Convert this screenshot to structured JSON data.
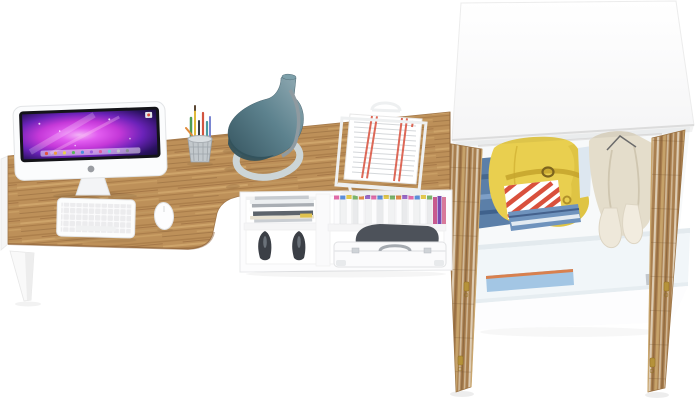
{
  "scene": {
    "description": "3D product render of a home office furniture set: wall desk with iMac, lamp and document tray over an open cubby shelf, next to a white wardrobe with open rustic-wood doors full of clothes",
    "background": "#ffffff",
    "objects": [
      "wooden desk with white frame and leg",
      "imac computer",
      "white keyboard",
      "white mouse",
      "pen cup with pens and pencils",
      "teal cone desk lamp",
      "wire document tray with papers",
      "open cubby shelf unit",
      "magazine stack",
      "black high-heel shoes",
      "row of white binders with colored tabs",
      "white suitcase",
      "wardrobe with open rustic doors",
      "yellow belted jacket",
      "beige coat",
      "folded jeans",
      "red striped folded shirt",
      "light blue storage box",
      "cream mittens"
    ]
  },
  "colors": {
    "wood": "#bd9059",
    "door_wood": "#a97f4f",
    "lamp_base": "#ccd5d7",
    "jacket_yellow": "#e9cf4f",
    "coat_cream": "#e4ddcb",
    "denim": "#5b7fa8",
    "stripe_red": "#d9503c",
    "shelf_box_blue": "#a3c6e4",
    "heel_black": "#3b3f46",
    "screen_magenta": "#c438d8"
  }
}
